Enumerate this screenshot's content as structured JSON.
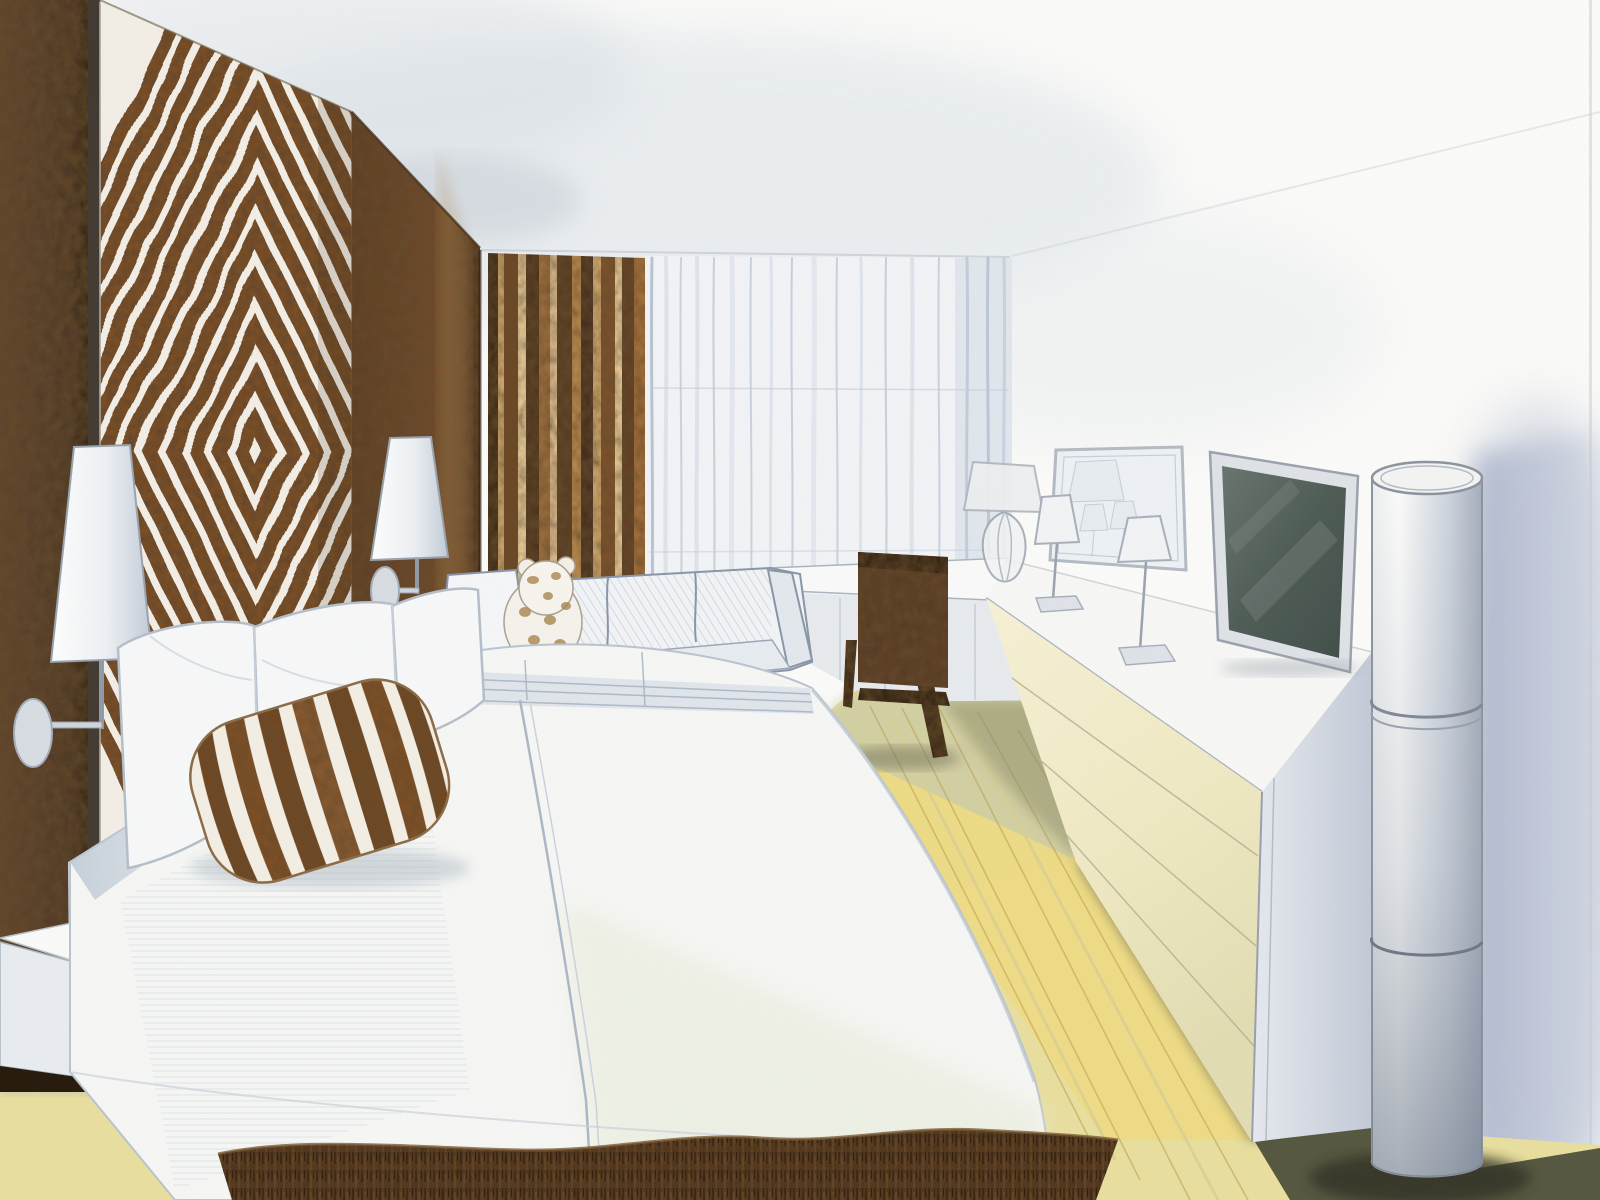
{
  "image": {
    "kind": "hand-drawn interior perspective sketch",
    "medium": "colored pencil and graphite on white paper",
    "subject": "hotel guest room bedroom interior in one-point perspective",
    "label": "Colored-pencil perspective rendering of a hotel bedroom"
  },
  "palette": {
    "paper_white": "#fcfcfa",
    "panel_stripe_brown": "#7b4e23",
    "wall_brown_dark": "#4f3118",
    "wall_brown_mid": "#6e4626",
    "curtain_brown": "#8a5c30",
    "curtain_tan": "#caa369",
    "sheer_blue_gray": "#c9d3df",
    "pencil_blue": "#9aa7b8",
    "bedding_white": "#f7f8f6",
    "bedding_green_tint": "#e8ecd8",
    "floor_yellow": "#e9df9e",
    "floor_olive_shadow": "#6e6e52",
    "rug_brown": "#4f3318",
    "chair_walnut": "#4e3015",
    "tv_screen": "#58655f",
    "shadow_blue": "#9fabc6"
  },
  "scene": {
    "elements": [
      {
        "name": "headboard-diamond-panel",
        "label": "Tall headboard panel with concentric brown and white diamond pattern"
      },
      {
        "name": "accent-wall",
        "label": "Dark brown accent wall behind the bed"
      },
      {
        "name": "wall-lamp-left",
        "label": "Wall-mounted swing-arm lamp with white conical shade, left of bed"
      },
      {
        "name": "wall-lamp-right",
        "label": "Wall-mounted swing-arm lamp with white conical shade, right of headboard"
      },
      {
        "name": "bed",
        "label": "King bed with white bedspread drawn in blue pencil shading"
      },
      {
        "name": "pillows",
        "label": "White pillows against the headboard"
      },
      {
        "name": "striped-pillow",
        "label": "Brown and white striped accent pillow"
      },
      {
        "name": "nightstand",
        "label": "Floating white nightstand at lower left"
      },
      {
        "name": "sofa",
        "label": "White sofa against the window wall"
      },
      {
        "name": "teddy-bear",
        "label": "Spotted teddy bear sitting on the sofa"
      },
      {
        "name": "brown-curtain",
        "label": "Brown striped drapery panel"
      },
      {
        "name": "sheer-curtain",
        "label": "Floor-to-ceiling white sheer curtains"
      },
      {
        "name": "desk-chair",
        "label": "Dark walnut desk chair seen from behind"
      },
      {
        "name": "desk",
        "label": "White built-in desk below the window"
      },
      {
        "name": "console",
        "label": "Long low white console / dresser with drawers along right wall"
      },
      {
        "name": "glass-table-lamp",
        "label": "Table lamp with sculpted glass base on desk corner"
      },
      {
        "name": "small-lamp-1",
        "label": "Small slim-stem table lamp on console"
      },
      {
        "name": "small-lamp-2",
        "label": "Small slim-stem table lamp on console"
      },
      {
        "name": "mirror",
        "label": "Framed mirror leaning on console reflecting the lamps"
      },
      {
        "name": "tv",
        "label": "Flat-screen TV with dark screen leaning on console"
      },
      {
        "name": "column-lamp",
        "label": "Tall white cylindrical floor lamp at right"
      },
      {
        "name": "wall-shadow",
        "label": "Soft blue shadow cast on the right wall"
      },
      {
        "name": "wood-floor",
        "label": "Light yellow wood plank floor"
      },
      {
        "name": "rug",
        "label": "Dark brown shaggy rug at the foot of the bed"
      },
      {
        "name": "ceiling",
        "label": "White ceiling with soft gray shading"
      }
    ]
  }
}
